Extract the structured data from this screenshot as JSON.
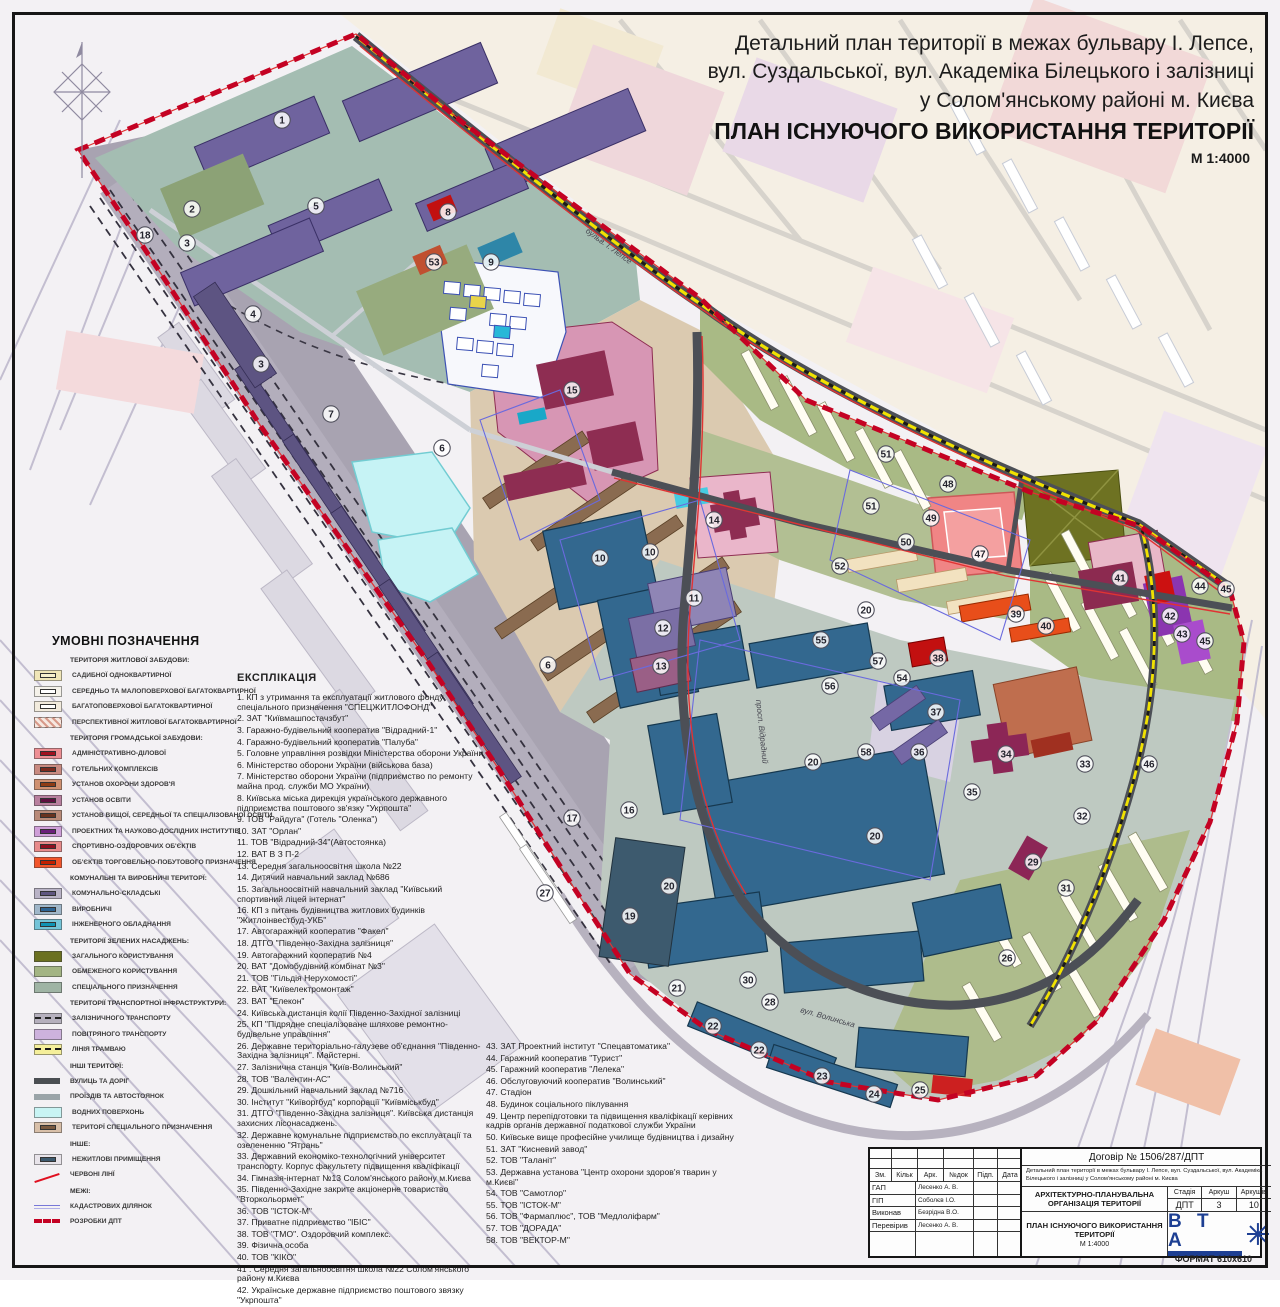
{
  "title": {
    "line1": "Детальний план території  в межах бульвару І. Лепсе,",
    "line2": "вул. Суздальської, вул. Академіка Білецького і залізниці",
    "line3": "у Солом'янському районі м. Києва",
    "main": "ПЛАН ІСНУЮЧОГО ВИКОРИСТАННЯ ТЕРИТОРІЇ",
    "scale": "М 1:4000"
  },
  "legend": {
    "heading": "УМОВНІ ПОЗНАЧЕННЯ",
    "groups": [
      {
        "heading": "ТЕРИТОРІЯ ЖИТЛОВОЇ ЗАБУДОВИ:",
        "items": [
          {
            "label": "САДИБНОЇ ОДНОКВАРТИРНОЇ",
            "type": "box",
            "bg": "#f0e6b8",
            "inner": "#f7f0cc"
          },
          {
            "label": "СЕРЕДНЬО ТА МАЛОПОВЕРХОВОЇ БАГАТОКВАРТИРНОЇ",
            "type": "box",
            "bg": "#f5f2ea",
            "inner": "#ffffff"
          },
          {
            "label": "БАГАТОПОВЕРХОВОЇ БАГАТОКВАРТИРНОЇ",
            "type": "box",
            "bg": "#f2ebdd",
            "inner": "#ffffff"
          },
          {
            "label": "ПЕРСПЕКТИВНОЇ ЖИТЛОВОЇ БАГАТОКВАРТИРНОЇ",
            "type": "hatch"
          }
        ]
      },
      {
        "heading": "ТЕРИТОРІЯ ГРОМАДСЬКОЇ ЗАБУДОВИ:",
        "items": [
          {
            "label": "АДМІНІСТРАТИВНО-ДІЛОВОЇ",
            "type": "box",
            "bg": "#ee8f94",
            "inner": "#a11220"
          },
          {
            "label": "ГОТЕЛЬНИХ КОМПЛЕКСІВ",
            "type": "box",
            "bg": "#c98a80",
            "inner": "#7c2a1e"
          },
          {
            "label": "УСТАНОВ ОХОРОНИ ЗДОРОВ'Я",
            "type": "box",
            "bg": "#cf9070",
            "inner": "#8e3c14"
          },
          {
            "label": "УСТАНОВ ОСВІТИ",
            "type": "box",
            "bg": "#b87f9e",
            "inner": "#5e1040"
          },
          {
            "label": "УСТАНОВ  ВИЩОЇ, СЕРЕДНЬОЇ ТА СПЕЦІАЛІЗОВАНОЇ ОСВІТИ",
            "type": "box",
            "bg": "#b98a78",
            "inner": "#69331f"
          },
          {
            "label": "ПРОЕКТНИХ ТА НАУКОВО-ДОСЛІДНИХ ІНСТИТУТІВ",
            "type": "box",
            "bg": "#cf9fd8",
            "inner": "#6a1f7a"
          },
          {
            "label": "СПОРТИВНО-ОЗДОРОВЧИХ ОБ'ЄКТІВ",
            "type": "box",
            "bg": "#e88b8b",
            "inner": "#8e1020"
          },
          {
            "label": "ОБ'ЄКТІВ ТОРГОВЕЛЬНО-ПОБУТОВОГО ПРИЗНАЧЕННЯ",
            "type": "box",
            "bg": "#f2552b",
            "inner": "#c22000"
          }
        ]
      },
      {
        "heading": "КОМУНАЛЬНІ ТА ВИРОБНИЧІ ТЕРИТОРЇ:",
        "items": [
          {
            "label": "КОМУНАЛЬНО-СКЛАДСЬКІ",
            "type": "box",
            "bg": "#b9b3c6",
            "inner": "#5f5680"
          },
          {
            "label": "ВИРОБНИЧІ",
            "type": "box",
            "bg": "#9fb6c9",
            "inner": "#2d6392"
          },
          {
            "label": "ІНЖЕНЕРНОГО ОБЛАДНАННЯ",
            "type": "box",
            "bg": "#74c4d8",
            "inner": "#0f93b4"
          }
        ]
      },
      {
        "heading": "ТЕРИТОРІЇ ЗЕЛЕНИХ НАСАДЖЕНЬ:",
        "items": [
          {
            "label": "ЗАГАЛЬНОГО КОРИСТУВАННЯ",
            "type": "solid",
            "bg": "#6b7020"
          },
          {
            "label": "ОБМЕЖЕНОГО КОРИСТУВАННЯ",
            "type": "solid",
            "bg": "#a3b483"
          },
          {
            "label": "СПЕЦІАЛЬНОГО ПРИЗНАЧЕННЯ",
            "type": "solid",
            "bg": "#9fb4a4"
          }
        ]
      },
      {
        "heading": "ТЕРИТОРІЇ ТРАНСПОРТНОЇ ІНФРАСТРУКТУРИ:",
        "items": [
          {
            "label": "ЗАЛІЗНИЧНОГО ТРАНСПОРТУ",
            "type": "rail"
          },
          {
            "label": "ПОВІТРЯНОГО ТРАНСПОРТУ",
            "type": "solid",
            "bg": "#cdb2dd"
          },
          {
            "label": "ЛІНІЯ ТРАМВАЮ",
            "type": "tram"
          }
        ]
      },
      {
        "heading": "ІНШІ ТЕРИТОРЇ:",
        "items": [
          {
            "label": "ВУЛИЦЬ ТА ДОРІГ",
            "type": "bar",
            "bg": "#4a4e52"
          },
          {
            "label": "ПРОЇЗДІВ ТА АВТОСТОЯНОК",
            "type": "bar",
            "bg": "#9aa4a8"
          },
          {
            "label": "ВОДНИХ ПОВЕРХОНЬ",
            "type": "solid",
            "bg": "#c8f4f4"
          },
          {
            "label": "ТЕРИТОРЇ СПЕЦІАЛЬНОГО ПРИЗНАЧЕННЯ",
            "type": "box",
            "bg": "#d8bfa8",
            "inner": "#7a5a40"
          }
        ]
      },
      {
        "heading": "ІНШЕ:",
        "items": [
          {
            "label": "НЕЖИТЛОВІ ПРИМІЩЕННЯ",
            "type": "box",
            "bg": "#e8e4ea",
            "inner": "#3d5a6e"
          },
          {
            "label": "ЧЕРВОНІ ЛІНЇ",
            "type": "redline"
          }
        ]
      },
      {
        "heading": "МЕЖІ:",
        "items": [
          {
            "label": "КАДАСТРОВИХ ДІЛЯНОК",
            "type": "cadline"
          },
          {
            "label": "РОЗРОБКИ ДПТ",
            "type": "dpt"
          }
        ]
      }
    ]
  },
  "explication": {
    "heading": "ЕКСПЛІКАЦІЯ",
    "col1": [
      "1. КП з утримання та експлуатації житлового фонду спеціального призначення  \"СПЕЦЖИТЛОФОНД\"",
      "2. ЗАТ \"Київмашпостачзбут\"",
      "3. Гаражно-будівельний кооператив \"Відрадний-1\"",
      "4. Гаражно-будівельний кооператив \"Палуба\"",
      "5. Головне управління розвідки Міністерства оборони України",
      "6. Міністерство оборони України (військова база)",
      "7. Міністерство оборони України (підприємство по ремонту майна прод. служби МО України)",
      "8. Київська міська дирекція українського державного підприємства поштового зв'язку \"Укрпошта\"",
      "9. ТОВ \"Райдуга\" (Готель \"Оленка\")",
      "10. ЗАТ \"Орлан\"",
      "11. ТОВ \"Відрадний-34\"(Автостоянка)",
      "12. ВАТ В З П-2",
      "13. Середня загальноосвітня школа №22",
      "14. Дитячий навчальний заклад №686",
      "15. Загальноосвітній навчальний заклад \"Київський спортивний ліцей інтернат\"",
      "16. КП з питань будівництва житлових будинків \"Житлоінвестбуд-УКБ\"",
      "17. Автогаражний кооператив \"Факел\"",
      "18. ДТГО \"Південно-Західна залізниця\"",
      "19. Автогаражний кооператив №4",
      "20. ВАТ \"Домобудівний комбінат №3\"",
      "21. ТОВ \"Гільдія Нерухомості\"",
      "22. ВАТ \"Київелектромонтаж\"",
      "23. ВАТ \"Елекон\"",
      "24. Київська дистанція колії Південно-Західної залізниці",
      "25. КП \"Підрядне спеціалізоване шляхове ремонтно-будівельне управління\"",
      "26. Державне територіально-галузеве об'єднання \"Південно-Західна залізниця\". Майстерні.",
      "27. Залізнична станція \"Київ-Волинський\"",
      "28. ТОВ \"Валентин-АС\"",
      "29. Дошкільний навчальний заклад №716",
      "30. Інститут \"Київоргбуд\" корпорації \"Київміськбуд\"",
      "31. ДТГО \"Південно-Західна залізниця\". Київська дистанція захисних лісонасаджень.",
      "32. Державне комунальне підприємство по експлуатації та озелененню \"Ятрань\"",
      "33. Державний економіко-технологічний університет транспорту. Корпус факультету підвищення кваліфікації",
      "34. Гімназія-інтернат №13 Солом'янського району м.Києва",
      "35. Південно-Західне закрите акціонерне товариство \"Вторкольормет\"",
      "36. ТОВ \"ІСТОК-М\"",
      "37. Приватне підприємство \"ІБІС\"",
      "38. ТОВ \"ТМО\". Оздоровчий комплекс.",
      "39. Фізична особа",
      "40. ТОВ \"КІКО\"",
      "41 . Середня загальноосвітня школа №22 Солом'янського району м.Києва",
      "42. Українське державне підприємство поштового звязку \"Укрпошта\""
    ],
    "col2": [
      "43. ЗАТ Проектний інститут \"Спецавтоматика\"",
      "44. Гаражний кооператив \"Турист\"",
      "45. Гаражний кооператив \"Лелека\"",
      "46. Обслуговуючий кооператив \"Волинський\"",
      "47. Стадіон",
      "48. Будинок соціального піклування",
      "49. Центр перепідготовки та підвищення кваліфікації керівних кадрів органів державної податкової служби України",
      "50. Київське вище професійне училище будівництва і дизайну",
      "51. ЗАТ \"Кисневий завод\"",
      "52. ТОВ \"Таланіт\"",
      "53. Державна установа \"Центр охорони здоров'я тварин у м.Києві\"",
      "54. ТОВ \"Самотлор\"",
      "55. ТОВ \"ІСТОК-М\"",
      "56. ТОВ \"Фармаплюс\", ТОВ \"Медлоліфарм\"",
      "57. ТОВ \"ДОРАДА\"",
      "58. ТОВ \"ВЕКТОР-М\""
    ]
  },
  "stamp": {
    "contract": "Договір № 1506/287/ДПТ",
    "project": "Детальний план території  в межах бульвару І. Лепсе, вул. Суздальської, вул. Академіка Білецького і залізниці у Солом'янському районі м. Києва",
    "header": [
      "Зм.",
      "Кільк",
      "Арк.",
      "№док",
      "Підп.",
      "Дата"
    ],
    "rows": [
      {
        "role": "ГАП",
        "name": "Лесенко А. В."
      },
      {
        "role": "ГІП",
        "name": "Соболєв І.О."
      },
      {
        "role": "Виконав",
        "name": "Безрідна В.О."
      },
      {
        "role": "Перевірив",
        "name": "Лесенко А. В."
      }
    ],
    "section": "АРХІТЕКТУРНО-ПЛАНУВАЛЬНА ОРГАНІЗАЦІЯ ТЕРИТОРІЇ",
    "stage_label": "Стадія",
    "sheet_label": "Аркуш",
    "sheets_label": "Аркушів",
    "stage": "ДПТ",
    "sheet": "3",
    "sheets": "10",
    "drawing": "ПЛАН ІСНУЮЧОГО ВИКОРИСТАННЯ ТЕРИТОРІЇ",
    "drawing_scale": "М 1:4000",
    "logo": "В Т А",
    "format": "ФОРМАТ 610х610"
  },
  "map": {
    "boundary_color": "#c40223",
    "tram_color": "#f1e200",
    "road_color": "#4c4f56",
    "labels": [
      {
        "n": "1",
        "x": 282,
        "y": 120
      },
      {
        "n": "2",
        "x": 192,
        "y": 209
      },
      {
        "n": "3",
        "x": 187,
        "y": 243
      },
      {
        "n": "3",
        "x": 261,
        "y": 364
      },
      {
        "n": "4",
        "x": 253,
        "y": 314
      },
      {
        "n": "5",
        "x": 316,
        "y": 206
      },
      {
        "n": "6",
        "x": 442,
        "y": 448
      },
      {
        "n": "6",
        "x": 548,
        "y": 665
      },
      {
        "n": "7",
        "x": 331,
        "y": 414
      },
      {
        "n": "8",
        "x": 448,
        "y": 212
      },
      {
        "n": "9",
        "x": 491,
        "y": 262
      },
      {
        "n": "10",
        "x": 600,
        "y": 558
      },
      {
        "n": "10",
        "x": 650,
        "y": 552
      },
      {
        "n": "11",
        "x": 694,
        "y": 598
      },
      {
        "n": "12",
        "x": 663,
        "y": 628
      },
      {
        "n": "13",
        "x": 661,
        "y": 666
      },
      {
        "n": "14",
        "x": 714,
        "y": 520
      },
      {
        "n": "15",
        "x": 572,
        "y": 390
      },
      {
        "n": "16",
        "x": 629,
        "y": 810
      },
      {
        "n": "17",
        "x": 572,
        "y": 818
      },
      {
        "n": "18",
        "x": 145,
        "y": 235
      },
      {
        "n": "19",
        "x": 630,
        "y": 916
      },
      {
        "n": "20",
        "x": 866,
        "y": 610
      },
      {
        "n": "20",
        "x": 813,
        "y": 762
      },
      {
        "n": "20",
        "x": 875,
        "y": 836
      },
      {
        "n": "20",
        "x": 669,
        "y": 886
      },
      {
        "n": "21",
        "x": 677,
        "y": 988
      },
      {
        "n": "22",
        "x": 713,
        "y": 1026
      },
      {
        "n": "22",
        "x": 759,
        "y": 1050
      },
      {
        "n": "23",
        "x": 822,
        "y": 1076
      },
      {
        "n": "24",
        "x": 874,
        "y": 1094
      },
      {
        "n": "25",
        "x": 920,
        "y": 1090
      },
      {
        "n": "26",
        "x": 1007,
        "y": 958
      },
      {
        "n": "27",
        "x": 545,
        "y": 893
      },
      {
        "n": "28",
        "x": 770,
        "y": 1002
      },
      {
        "n": "29",
        "x": 1033,
        "y": 862
      },
      {
        "n": "30",
        "x": 748,
        "y": 980
      },
      {
        "n": "31",
        "x": 1066,
        "y": 888
      },
      {
        "n": "32",
        "x": 1082,
        "y": 816
      },
      {
        "n": "33",
        "x": 1085,
        "y": 764
      },
      {
        "n": "34",
        "x": 1006,
        "y": 754
      },
      {
        "n": "35",
        "x": 972,
        "y": 792
      },
      {
        "n": "36",
        "x": 919,
        "y": 752
      },
      {
        "n": "37",
        "x": 936,
        "y": 712
      },
      {
        "n": "38",
        "x": 938,
        "y": 658
      },
      {
        "n": "39",
        "x": 1016,
        "y": 614
      },
      {
        "n": "40",
        "x": 1046,
        "y": 626
      },
      {
        "n": "41",
        "x": 1120,
        "y": 578
      },
      {
        "n": "42",
        "x": 1170,
        "y": 616
      },
      {
        "n": "43",
        "x": 1182,
        "y": 634
      },
      {
        "n": "44",
        "x": 1200,
        "y": 586
      },
      {
        "n": "45",
        "x": 1226,
        "y": 589
      },
      {
        "n": "45",
        "x": 1205,
        "y": 641
      },
      {
        "n": "46",
        "x": 1149,
        "y": 764
      },
      {
        "n": "47",
        "x": 980,
        "y": 554
      },
      {
        "n": "48",
        "x": 948,
        "y": 484
      },
      {
        "n": "49",
        "x": 931,
        "y": 518
      },
      {
        "n": "50",
        "x": 906,
        "y": 542
      },
      {
        "n": "51",
        "x": 871,
        "y": 506
      },
      {
        "n": "51",
        "x": 886,
        "y": 454
      },
      {
        "n": "52",
        "x": 840,
        "y": 566
      },
      {
        "n": "53",
        "x": 434,
        "y": 262
      },
      {
        "n": "54",
        "x": 902,
        "y": 678
      },
      {
        "n": "55",
        "x": 821,
        "y": 640
      },
      {
        "n": "56",
        "x": 830,
        "y": 686
      },
      {
        "n": "57",
        "x": 878,
        "y": 661
      },
      {
        "n": "58",
        "x": 866,
        "y": 752
      }
    ],
    "streets": [
      {
        "t": "просп. Відрадний",
        "x": 756,
        "y": 700,
        "r": 84
      },
      {
        "t": "бульв. І. Лепсе",
        "x": 585,
        "y": 232,
        "r": 36
      },
      {
        "t": "вул. Волинська",
        "x": 800,
        "y": 1012,
        "r": 16
      }
    ]
  }
}
